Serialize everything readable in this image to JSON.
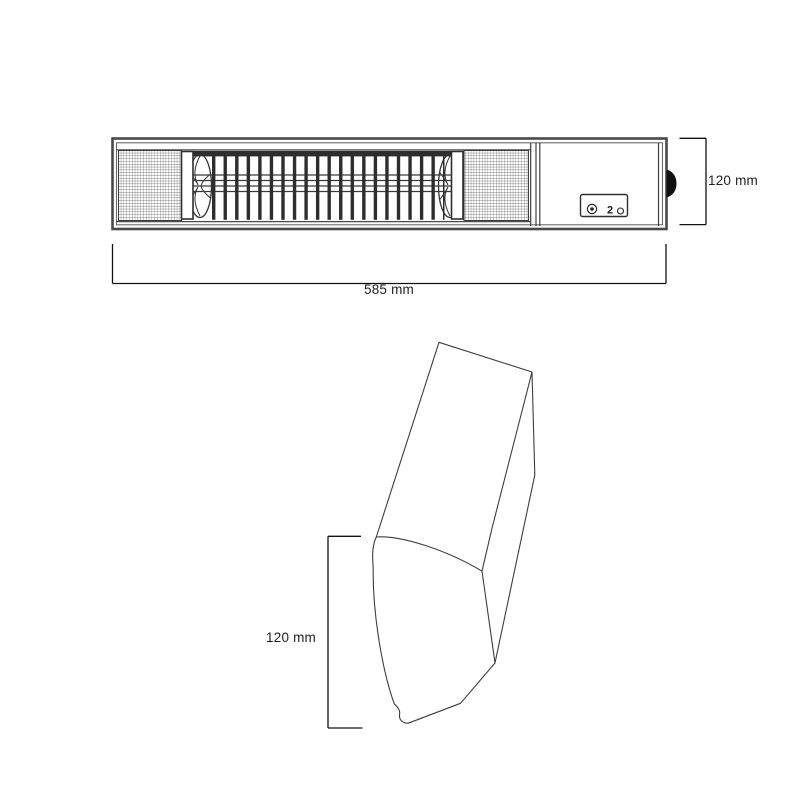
{
  "front_view": {
    "width_dimension": "585 mm",
    "height_dimension": "120 mm"
  },
  "side_view": {
    "height_dimension": "120 mm"
  },
  "icons": {
    "timer_glyph": "2",
    "power_dial": "circle-dial-icon",
    "knob": "side-power-knob-icon"
  },
  "colors": {
    "background": "#ffffff",
    "frame": "#4a4a4a",
    "line": "#3d3d3d",
    "grill": "#2d2d2d",
    "dimension": "#111111",
    "knob": "#101010"
  }
}
